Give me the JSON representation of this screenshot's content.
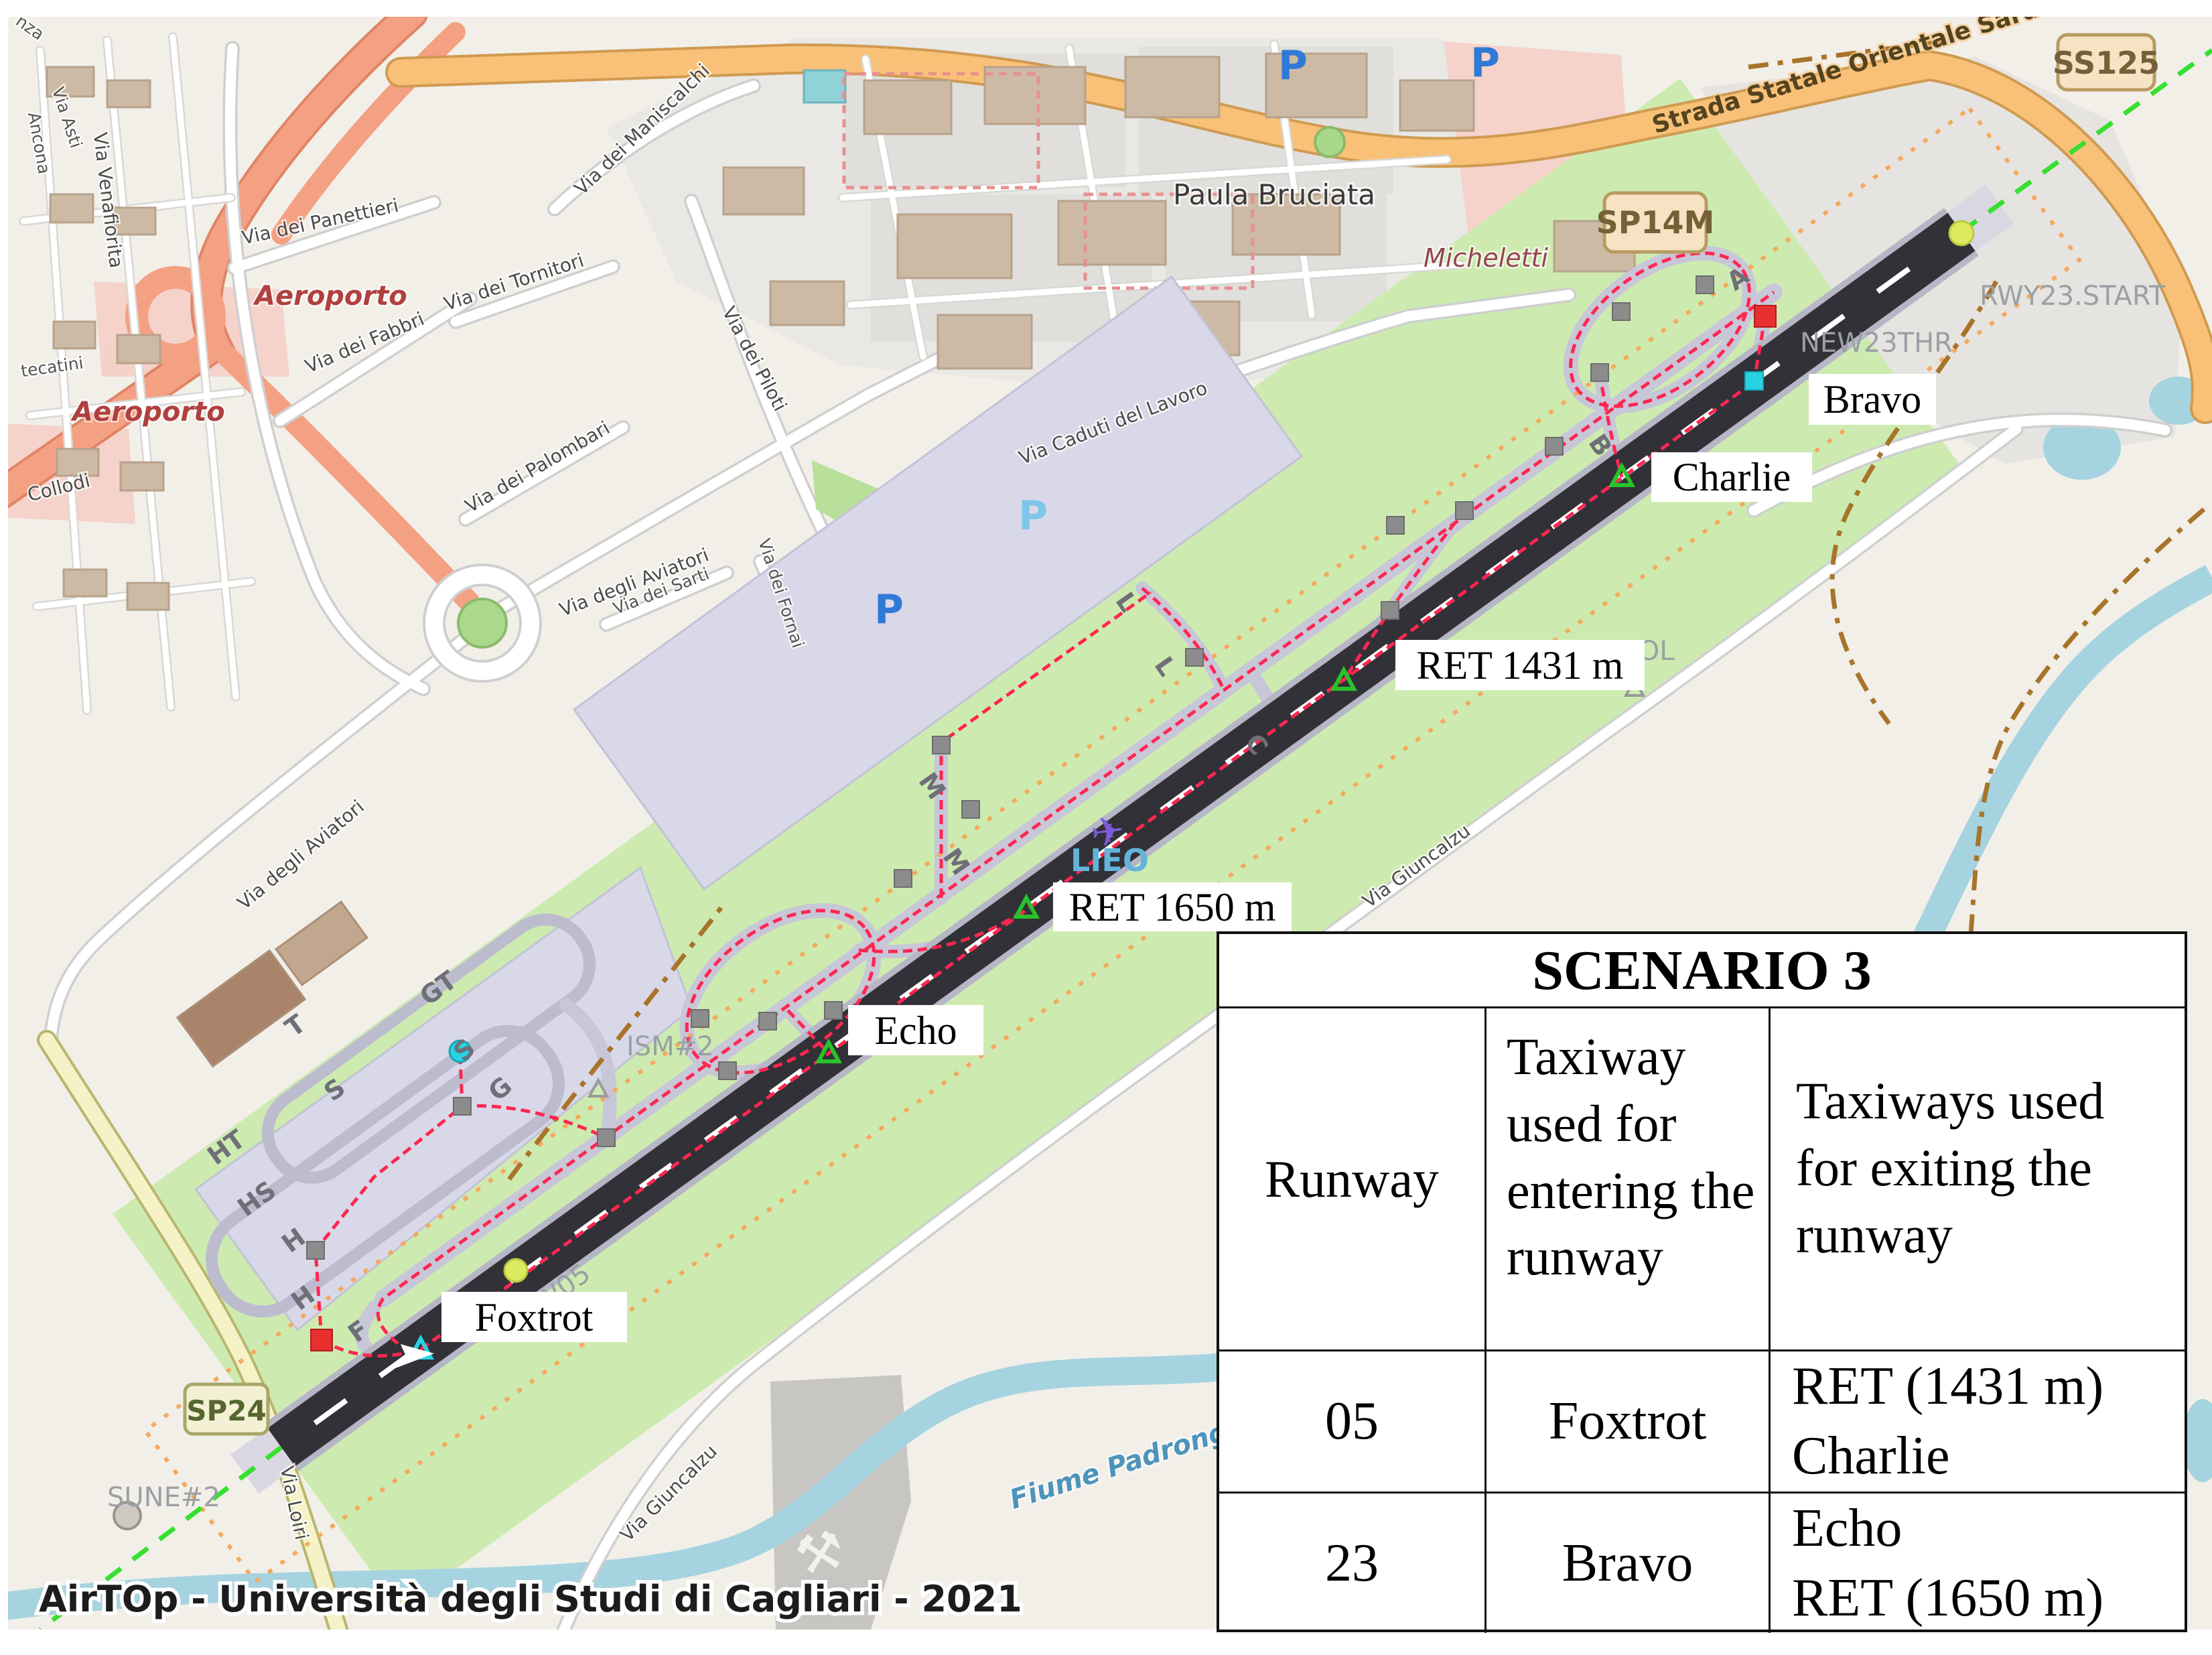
{
  "watermark": "AirTOp - Università degli Studi di Cagliari - 2021",
  "badges": {
    "sp14m": "SP14M",
    "ss125": "SS125",
    "sp24": "SP24"
  },
  "roads": {
    "strada_statale": "Strada Statale Orientale Sarda",
    "aviatori": "Via degli Aviatori",
    "piloti": "Via dei Piloti",
    "caduti": "Via Caduti del Lavoro",
    "maniscalchi": "Via dei Maniscalchi",
    "tornitori": "Via dei Tornitori",
    "fabbri": "Via dei Fabbri",
    "palombari": "Via dei Palombari",
    "panettieri": "Via dei Panettieri",
    "sarti": "Via dei Sarti",
    "fornai": "Via dei Fornai",
    "venafiorita": "Via Venafiorita",
    "asti": "Via Asti",
    "ancona": "Ancona",
    "nza": "nza",
    "tecatini": "tecatini",
    "collodi": "Collodi",
    "loiri": "Via Loiri",
    "giuncalzu": "Via Giuncalzu"
  },
  "places": {
    "aeroporto": "Aeroporto",
    "paula_bruciata": "Paula Bruciata",
    "micheletti": "Micheletti",
    "fiume": "Fiume Padrongiano"
  },
  "airport_labels": {
    "rwy23_start": "RWY23.START",
    "new23thr": "NEW23THR",
    "lieo": "LIEO",
    "iol": "IOL",
    "ism2": "ISM#2",
    "sune2": "SUNE#2",
    "rw05": "RW05"
  },
  "callouts": {
    "bravo": "Bravo",
    "charlie": "Charlie",
    "ret1431": "RET 1431 m",
    "ret1650": "RET 1650 m",
    "echo": "Echo",
    "foxtrot": "Foxtrot"
  },
  "taxiway_letters": {
    "gt": "GT",
    "s_apron": "S",
    "g": "G",
    "t": "T",
    "s_inner": "S",
    "ht": "HT",
    "hs": "HS",
    "h1": "H",
    "h2": "H",
    "f": "F",
    "m1": "M",
    "m2": "M",
    "l1": "L",
    "l2": "L",
    "c": "C",
    "a": "A",
    "b": "B"
  },
  "parking": "P",
  "table": {
    "title": "SCENARIO 3",
    "columns": [
      "Runway",
      "Taxiway used for entering the runway",
      "Taxiways used for exiting the runway"
    ],
    "rows": [
      {
        "runway": "05",
        "entering": "Foxtrot",
        "exiting": [
          "RET (1431 m)",
          "Charlie"
        ]
      },
      {
        "runway": "23",
        "entering": "Bravo",
        "exiting": [
          "Echo",
          "RET (1650 m)"
        ]
      }
    ]
  }
}
